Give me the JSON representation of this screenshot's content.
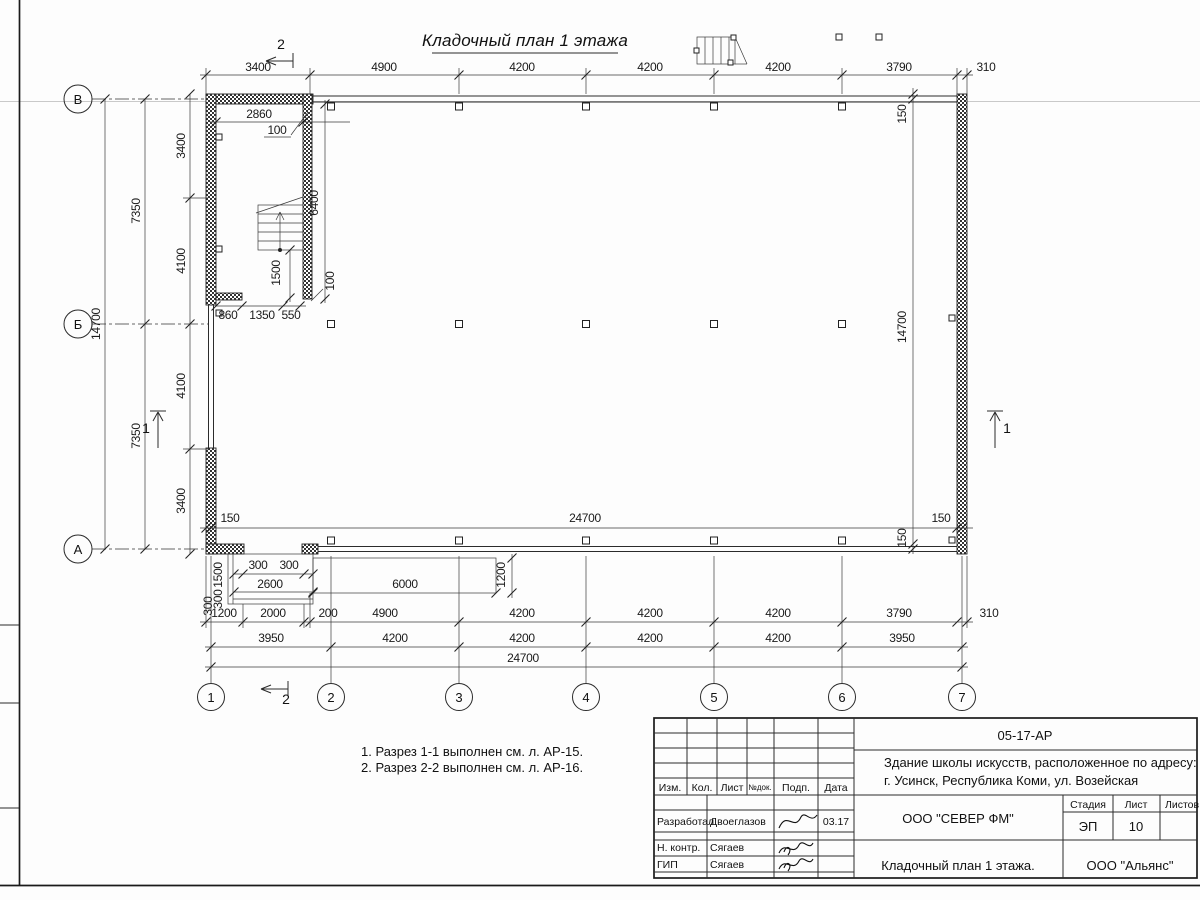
{
  "sheet": {
    "title": "Кладочный план 1 этажа"
  },
  "notes": {
    "line1": "1. Разрез 1-1 выполнен см. л. АР-15.",
    "line2": "2. Разрез 2-2 выполнен см. л. АР-16."
  },
  "axes": {
    "row_top": "В",
    "row_mid": "Б",
    "row_bot": "А",
    "cols": [
      "1",
      "2",
      "3",
      "4",
      "5",
      "6",
      "7"
    ]
  },
  "sections": {
    "one": "1",
    "two": "2"
  },
  "dims": {
    "top": [
      "3400",
      "4900",
      "4200",
      "4200",
      "4200",
      "3790",
      "310"
    ],
    "left": {
      "total": "14700",
      "half1": "7350",
      "half2": "7350",
      "sub": [
        "3400",
        "4100",
        "4100",
        "3400"
      ]
    },
    "right": {
      "top150": "150",
      "total": "14700",
      "bottom150": "150"
    },
    "inner": {
      "left150": "150",
      "span": "24700",
      "right150": "150"
    },
    "stair": {
      "width": "2860",
      "lead_top": "100",
      "height": "6400",
      "flight": "1500",
      "lead_bottom": "100",
      "b860": "860",
      "b1350": "1350",
      "b550": "550"
    },
    "porch": {
      "s1": "300",
      "s2": "300",
      "w2600": "2600",
      "w6000": "6000",
      "h1200": "1200",
      "v1500": "1500",
      "v300a": "300",
      "v300b": "300"
    },
    "row1": [
      "1200",
      "2000",
      "200",
      "4900",
      "4200",
      "4200",
      "4200",
      "3790",
      "310"
    ],
    "row2": [
      "3950",
      "4200",
      "4200",
      "4200",
      "4200",
      "3950"
    ],
    "row3": "24700"
  },
  "titleblock": {
    "doc_number": "05-17-АР",
    "project_line1": "Здание школы искусств, расположенное по адресу:",
    "project_line2": "г. Усинск, Республика Коми, ул. Возейская",
    "header_cols": [
      "Изм.",
      "Кол.",
      "Лист",
      "№док.",
      "Подп.",
      "Дата"
    ],
    "stage_label": "Стадия",
    "sheet_label": "Лист",
    "sheets_label": "Листов",
    "stage": "ЭП",
    "sheet_no": "10",
    "company": "ООО \"СЕВЕР ФМ\"",
    "sheet_title": "Кладочный план 1 этажа.",
    "contractor": "ООО \"Альянс\"",
    "roles": [
      {
        "role": "Разработал",
        "name": "Двоеглазов",
        "date": "03.17"
      },
      {
        "role": "Н. контр.",
        "name": "Сягаев",
        "date": ""
      },
      {
        "role": "ГИП",
        "name": "Сягаев",
        "date": ""
      }
    ]
  }
}
